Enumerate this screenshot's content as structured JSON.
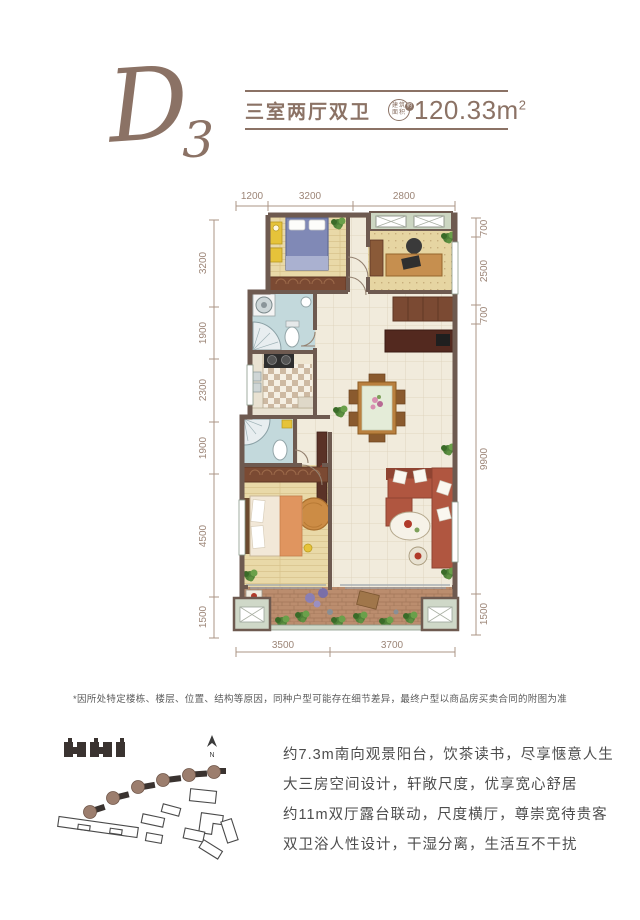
{
  "header": {
    "unit_code_letter": "D",
    "unit_code_number": "3",
    "layout_name": "三室两厅双卫",
    "area_badge_top": "建筑",
    "area_badge_bottom": "面积",
    "area_badge_approx": "约",
    "area_value": "120.33",
    "area_unit": "m",
    "area_exponent": "2"
  },
  "floor_plan": {
    "dim_top": [
      "1200",
      "3200",
      "2800"
    ],
    "dim_bottom": [
      "3500",
      "3700"
    ],
    "dim_left": [
      "3200",
      "1900",
      "2300",
      "1900",
      "4500",
      "1500"
    ],
    "dim_right": [
      "700",
      "2500",
      "700",
      "9900",
      "1500"
    ]
  },
  "disclaimer": "*因所处特定楼栋、楼层、位置、结构等原因，同种户型可能存在细节差异，最终户型以商品房买卖合同的附图为准",
  "site_map": {
    "north_label": "N"
  },
  "features": [
    "约7.3m南向观景阳台，饮茶读书，尽享惬意人生",
    "大三房空间设计，轩敞尺度，优享宽心舒居",
    "约11m双厅露台联动，尺度横厅，尊崇宽待贵客",
    "双卫浴人性设计，干湿分离，生活互不干扰"
  ],
  "colors": {
    "brand": "#8b7265",
    "dimension": "#9c8577",
    "wall": "#6e5a50",
    "body_text": "#4d4d4d"
  }
}
